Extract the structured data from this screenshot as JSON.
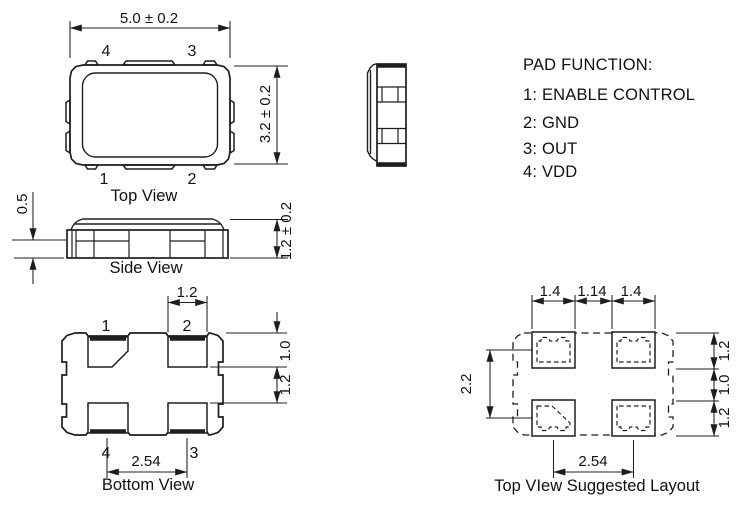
{
  "drawing": {
    "background": "#ffffff",
    "line_color": "#1e1e1e"
  },
  "top_view": {
    "label": "Top View",
    "width_dim": "5.0 ± 0.2",
    "height_dim": "3.2 ± 0.2",
    "pin_top_left": "4",
    "pin_top_right": "3",
    "pin_bottom_left": "1",
    "pin_bottom_right": "2"
  },
  "side_view": {
    "label": "Side View",
    "standoff_dim": "0.5",
    "height_dim": "1.2 ± 0.2"
  },
  "bottom_view": {
    "label": "Bottom View",
    "pad_width_dim": "1.2",
    "pad_height_dim": "1.0",
    "pad_gap_dim": "1.2",
    "pitch_dim": "2.54",
    "pin_top_left": "1",
    "pin_top_right": "2",
    "pin_bottom_left": "4",
    "pin_bottom_right": "3"
  },
  "layout_view": {
    "label": "Top VIew Suggested Layout",
    "pad_width_left_dim": "1.4",
    "pad_gap_h_dim": "1.14",
    "pad_width_right_dim": "1.4",
    "vertical_span_dim": "2.2",
    "pad_height_top_dim": "1.2",
    "pad_gap_v_dim": "1.0",
    "pad_height_bottom_dim": "1.2",
    "pitch_dim": "2.54"
  },
  "pad_function": {
    "title": "PAD FUNCTION:",
    "items": [
      "1: ENABLE CONTROL",
      "2: GND",
      "3: OUT",
      "4: VDD"
    ]
  }
}
